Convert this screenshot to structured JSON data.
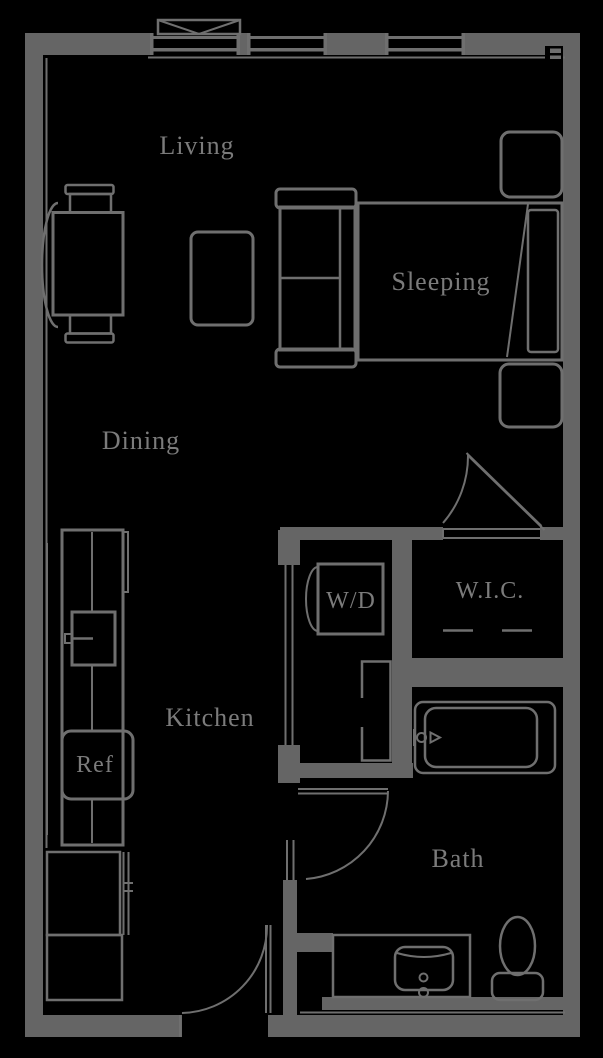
{
  "floorplan": {
    "title": "Studio apartment floor plan",
    "colors": {
      "background": "#000000",
      "wall": "#656565",
      "line": "#6f6f6f",
      "label": "#7b7b7b"
    },
    "rooms": {
      "living": {
        "label": "Living"
      },
      "sleeping": {
        "label": "Sleeping"
      },
      "dining": {
        "label": "Dining"
      },
      "kitchen": {
        "label": "Kitchen"
      },
      "bath": {
        "label": "Bath"
      },
      "wic": {
        "label": "W.I.C."
      },
      "wd": {
        "label": "W/D"
      },
      "ref": {
        "label": "Ref"
      }
    }
  }
}
